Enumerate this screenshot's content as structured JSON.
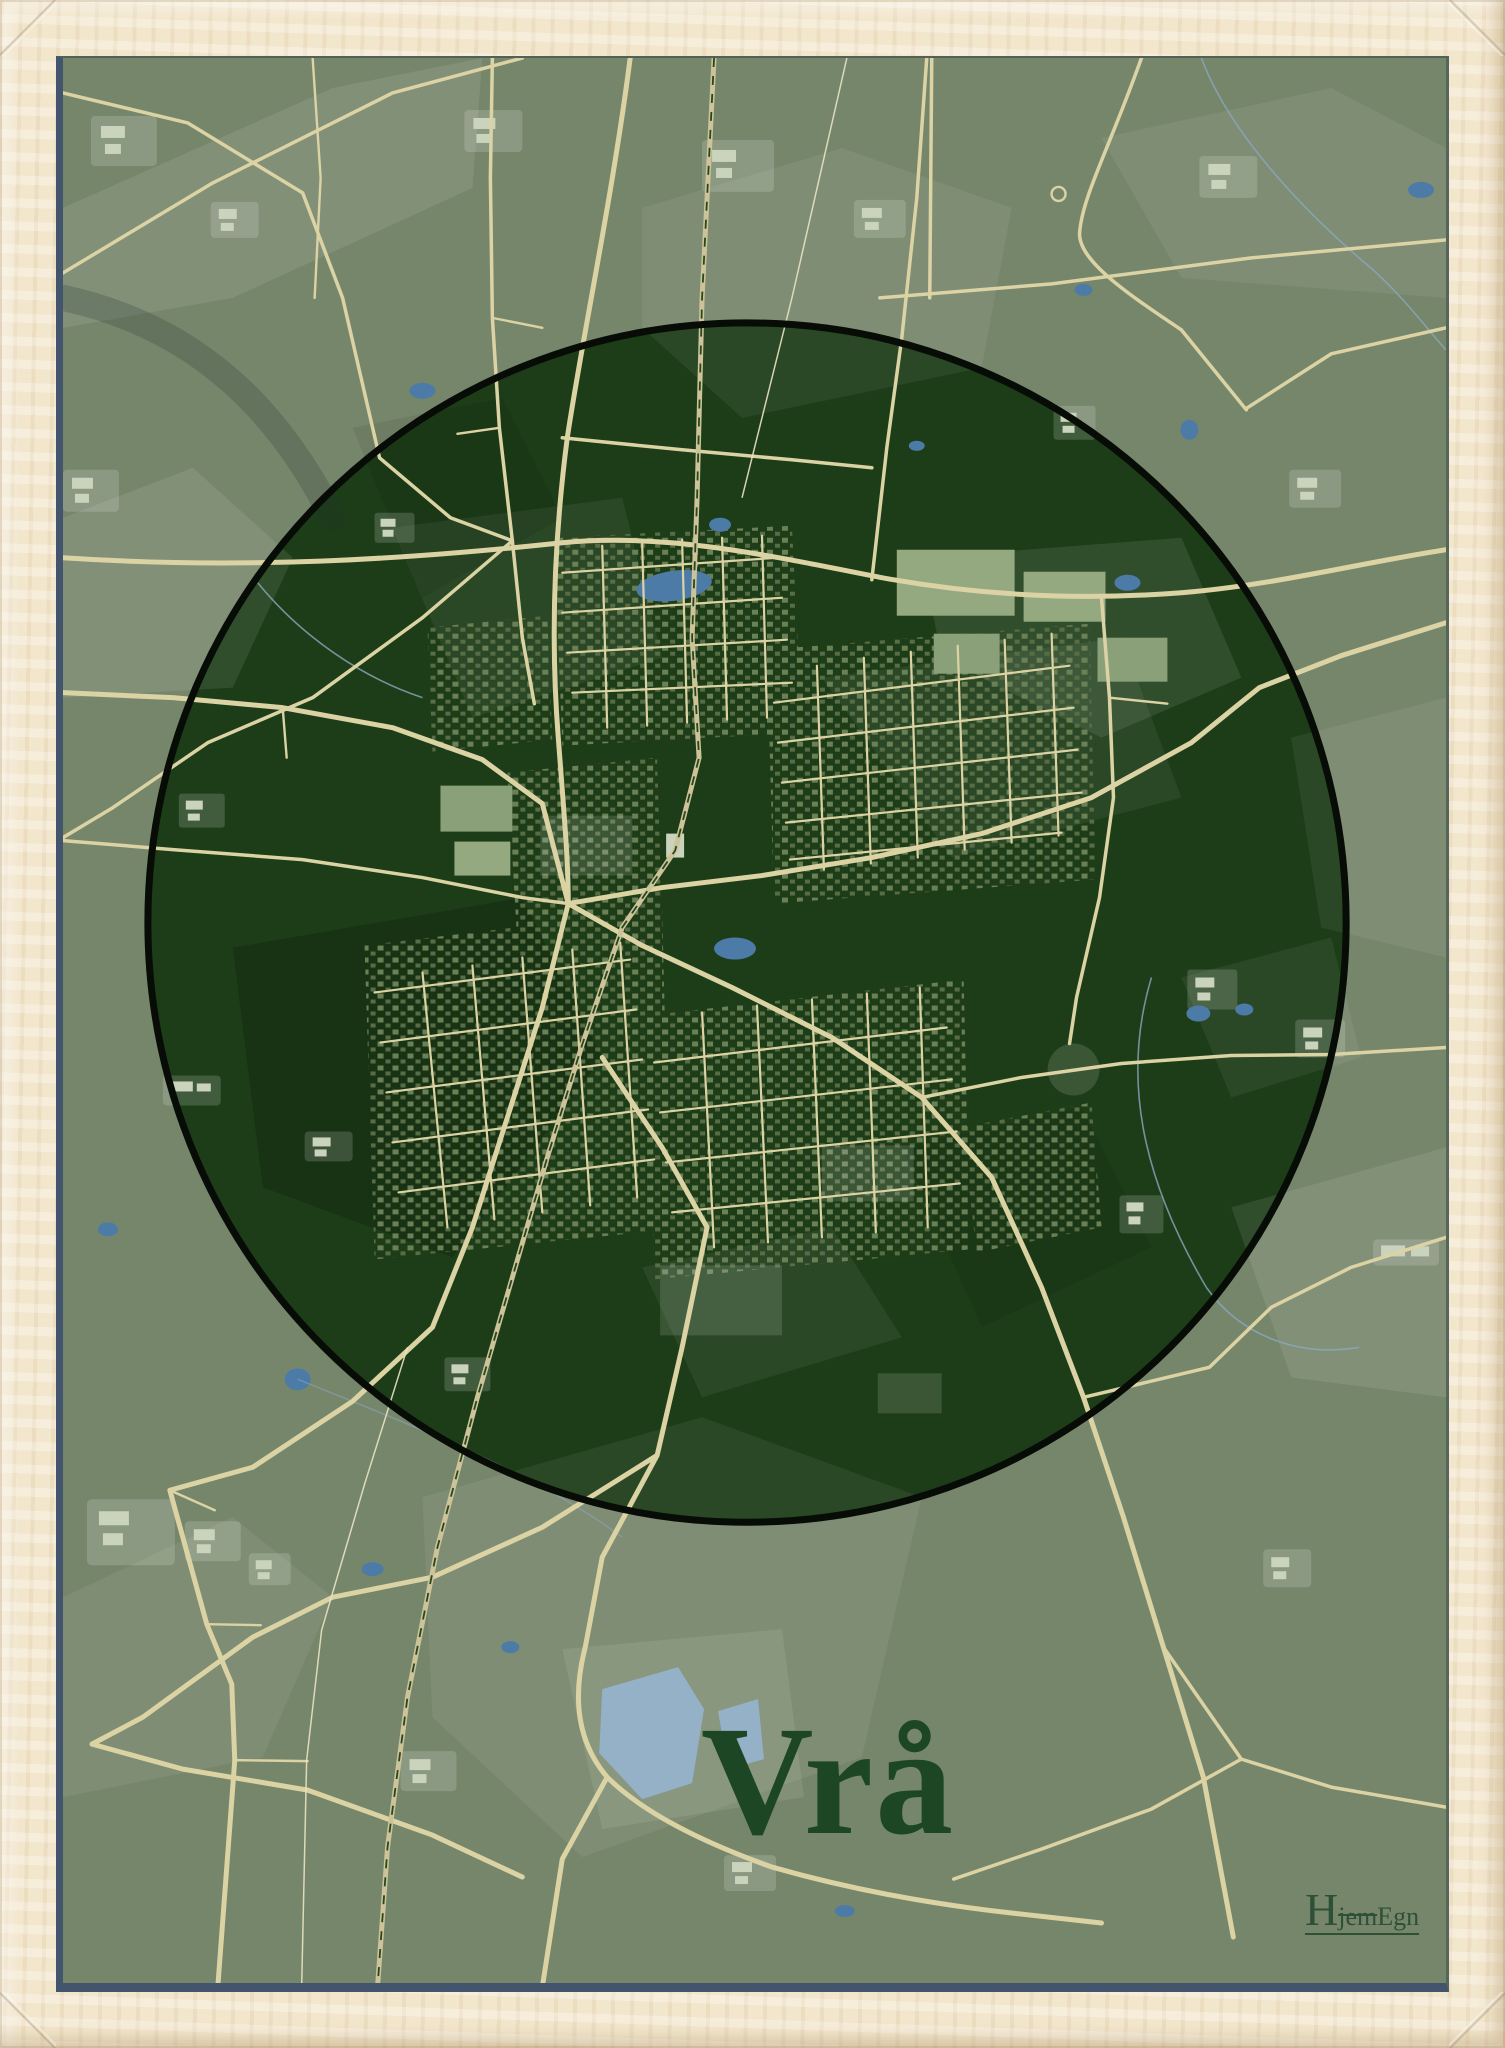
{
  "poster": {
    "title": "Vrå",
    "logo": {
      "full": "HjemEgn",
      "initial": "H",
      "mid": "jem",
      "end": "Egn"
    }
  },
  "colors": {
    "wood": "#f2e6cc",
    "wooddark": "#d9c5a2",
    "sage": "#76866b",
    "circle": "#1d3d18",
    "ring": "#080c07",
    "road": "#dcd3a5",
    "path": "#eae2c2",
    "rail": "#cdc398",
    "raildash": "#274621",
    "water": "#4d7ba7",
    "water2": "#95b1c8",
    "stream": "#8ba8bf",
    "house": "#6b8055",
    "house2": "#586d45",
    "bigbld": "#95a981",
    "bigbld2": "#8aa078",
    "farmbld": "#cad3bc",
    "navy": "#43546d",
    "title": "#1d4724",
    "logo": "#2e5037"
  }
}
